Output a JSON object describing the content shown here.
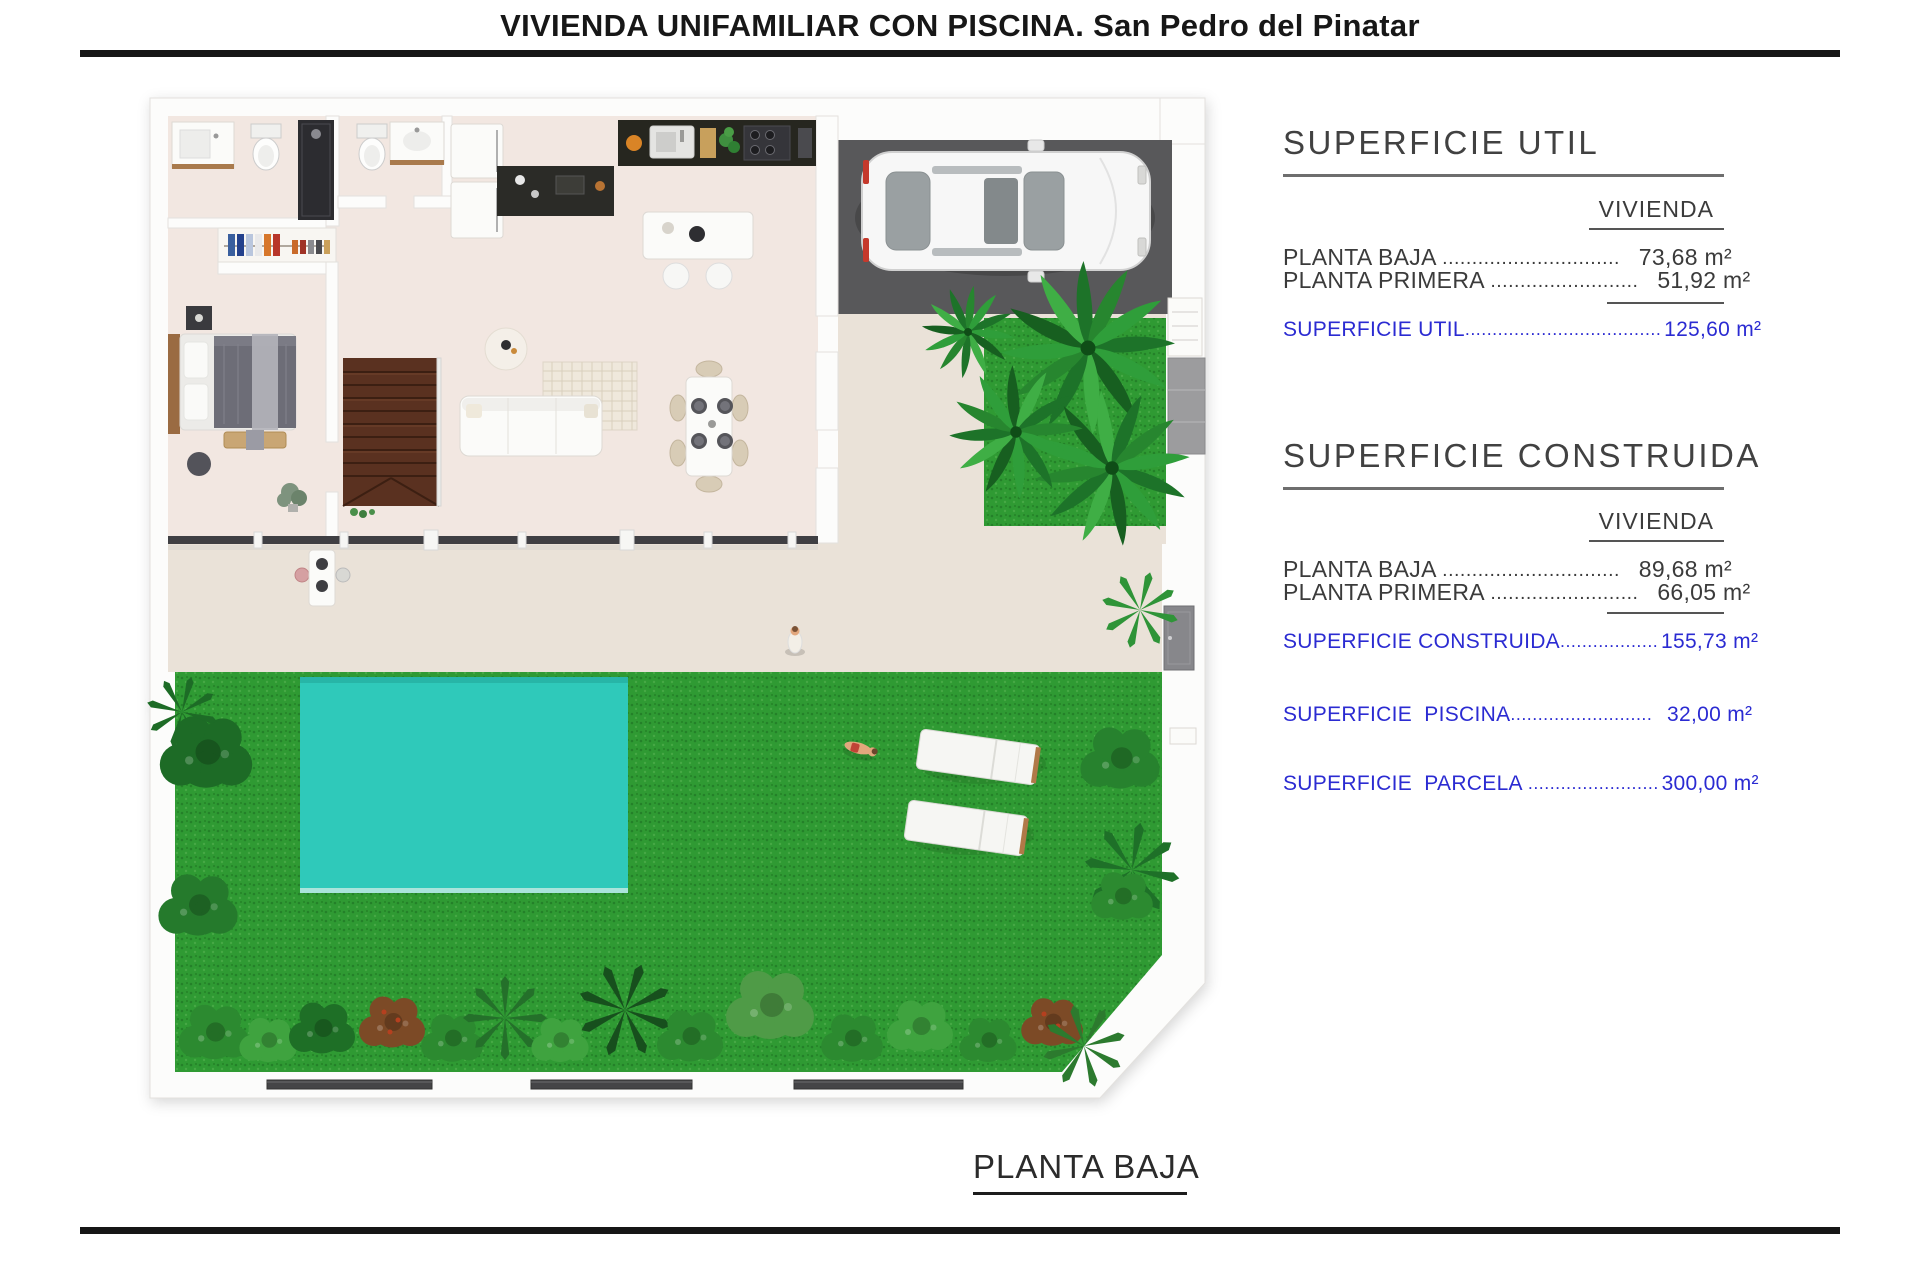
{
  "title": "VIVIENDA UNIFAMILIAR CON PISCINA. San Pedro del Pinatar",
  "footer_label": "PLANTA BAJA",
  "panel": {
    "sections": [
      {
        "heading": "SUPERFICIE UTIL",
        "column_header": "VIVIENDA",
        "rows": [
          {
            "label": "PLANTA BAJA ",
            "leader": "..............................",
            "value": "73,68 m²"
          },
          {
            "label": "PLANTA PRIMERA ",
            "leader": ".........................",
            "value": "51,92 m²"
          }
        ],
        "total": {
          "label": "SUPERFICIE UTIL",
          "leader": "....................................",
          "value": "125,60 m²"
        }
      },
      {
        "heading": "SUPERFICIE CONSTRUIDA",
        "column_header": "VIVIENDA",
        "rows": [
          {
            "label": "PLANTA BAJA ",
            "leader": "..............................",
            "value": "89,68 m²"
          },
          {
            "label": "PLANTA PRIMERA ",
            "leader": ".........................",
            "value": "66,05 m²"
          }
        ],
        "total": {
          "label": "SUPERFICIE CONSTRUIDA",
          "leader": "..................",
          "value": "155,73 m²"
        }
      }
    ],
    "extra_totals": [
      {
        "label": "SUPERFICIE  PISCINA",
        "leader": "..........................",
        "value": "32,00 m²"
      },
      {
        "label": "SUPERFICIE  PARCELA ",
        "leader": "........................",
        "value": "300,00 m²"
      }
    ]
  },
  "colors": {
    "accent_blue": "#2b2bd2",
    "grass": "#2f9a33",
    "pool": "#2fc9ba",
    "garage_floor": "#58585a",
    "house_floor": "#f2e7e1",
    "terrace": "#eae2d8",
    "stairs_wood": "#5a3120",
    "rule_black": "#161616"
  }
}
